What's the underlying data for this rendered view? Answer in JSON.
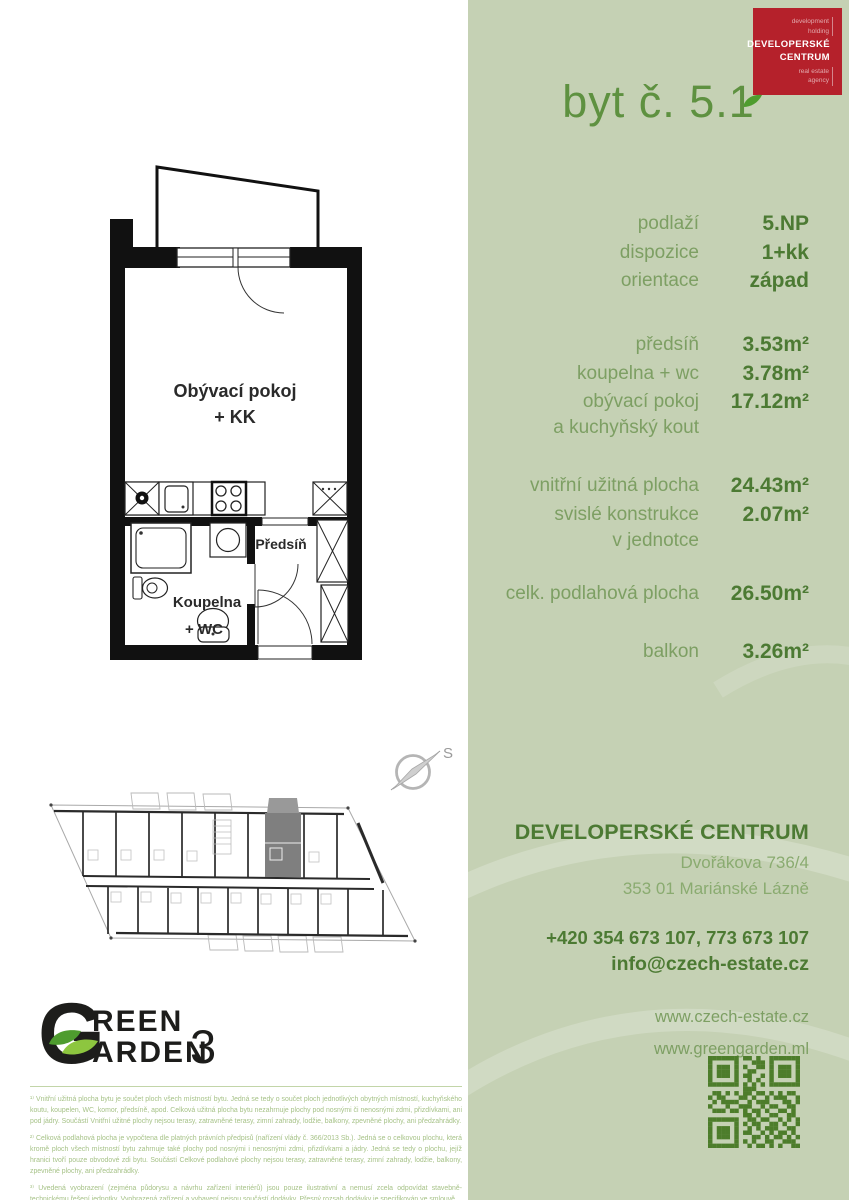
{
  "page": {
    "unit_title": "byt č. 5.1"
  },
  "agency_logo": {
    "tag1a": "development",
    "tag1b": "holding",
    "name1": "DEVELOPERSKÉ",
    "name2": "CENTRUM",
    "tag2a": "real estate",
    "tag2b": "agency",
    "background": "#b5212b"
  },
  "info": {
    "rows": [
      {
        "label": "podlaží",
        "value": "5.NP"
      },
      {
        "label": "dispozice",
        "value": "1+kk"
      },
      {
        "label": "orientace",
        "value": "západ"
      },
      {
        "label": "předsíň",
        "value": "3.53m²"
      },
      {
        "label": "koupelna + wc",
        "value": "3.78m²"
      },
      {
        "label": "obývací pokoj\na kuchyňský kout",
        "value": "17.12m²"
      },
      {
        "label": "vnitřní užitná plocha",
        "value": "24.43m²"
      },
      {
        "label": "svislé konstrukce\nv jednotce",
        "value": "2.07m²"
      },
      {
        "label": "celk. podlahová plocha",
        "value": "26.50m²"
      },
      {
        "label": "balkon",
        "value": "3.26m²"
      }
    ]
  },
  "floorplan": {
    "living_room_line1": "Obývací pokoj",
    "living_room_line2": "+ KK",
    "hallway": "Předsíň",
    "bathroom_line1": "Koupelna",
    "bathroom_line2": "+ WC",
    "compass_north": "S"
  },
  "contact": {
    "company": "DEVELOPERSKÉ CENTRUM",
    "address_line1": "Dvořákova 736/4",
    "address_line2": "353 01 Mariánské Lázně",
    "phones": "+420 354 673 107, 773 673 107",
    "email": "info@czech-estate.cz",
    "web1": "www.czech-estate.cz",
    "web2": "www.greengarden.ml"
  },
  "brand": {
    "g": "G",
    "row1": "REEN",
    "row2": "ARDEN",
    "three": "3"
  },
  "footnotes": {
    "p1": "¹⁾ Vnitřní užitná plocha bytu je součet ploch všech místností bytu. Jedná se tedy o součet ploch jednotlivých obytných místností, kuchyňského koutu, koupelen, WC, komor, předsíně, apod. Celková užitná plocha bytu nezahrnuje plochy pod nosnými či nenosnými zdmi, přizdívkami, ani pod jádry. Součástí Vnitřní užitné plochy nejsou terasy, zatravněné terasy, zimní zahrady, lodžie, balkony, zpevněné plochy, ani předzahrádky.",
    "p2": "²⁾ Celková podlahová plocha je vypočtena dle platných právních předpisů (nařízení vlády č. 366/2013 Sb.). Jedná se o celkovou plochu, která kromě ploch všech místností bytu zahrnuje také plochy pod nosnými i nenosnými zdmi, přizdívkami a jádry. Jedná se tedy o plochu, jejíž hranici tvoří pouze obvodové zdi bytu. Součástí Celkové podlahové plochy nejsou terasy, zatravněné terasy, zimní zahrady, lodžie, balkony, zpevněné plochy, ani předzahrádky.",
    "p3": "³⁾ Uvedená vyobrazení (zejména půdorysu a návrhu zařízení interiérů) jsou pouze ilustrativní a nemusí zcela odpovídat stavebně-technickému řešení jednotky. Vyobrazená zařízení a vybavení nejsou součástí dodávky. Přesný rozsah dodávky je specifikován ve smlouvě."
  },
  "colors": {
    "panel_green": "#c5d1b4",
    "accent_dark_green": "#4c7a33",
    "label_green": "#7d9f63",
    "title_green": "#5e9140",
    "logo_red": "#b5212b",
    "footnote_green": "#a6c287",
    "qr_green": "#4d7d2b"
  },
  "qr": {
    "modules": [
      "111111101101001111111",
      "100000100011101000001",
      "101110101001101011101",
      "101110100110001011101",
      "101110101100101011101",
      "100000100101001000001",
      "111111101010101111111",
      "000000001110000000000",
      "011010101101101010110",
      "101100011010010111001",
      "010111100101110001101",
      "100010011100101100110",
      "011101101011010011010",
      "000000001101001100110",
      "111111100110110010101",
      "100000101011001101001",
      "101110100101011100110",
      "101110101100101011010",
      "101110100011010110101",
      "100000101010011001110",
      "111111100101101010011"
    ]
  }
}
